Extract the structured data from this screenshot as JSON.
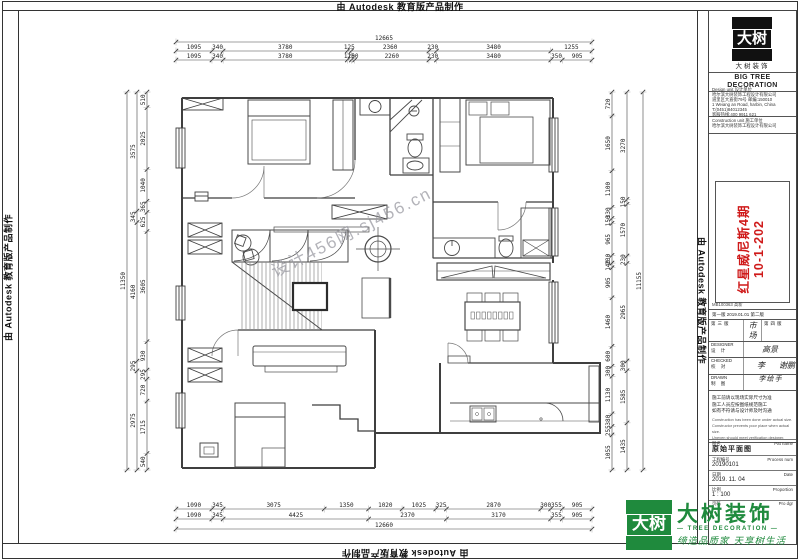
{
  "banner": {
    "text": "由 Autodesk 教育版产品制作"
  },
  "watermark": {
    "text": "设计456网.sj456.cn"
  },
  "dims": {
    "top": {
      "overall": "12665",
      "coarse": [
        "1095",
        "340",
        "3780",
        "125",
        "2360",
        "230",
        "3480",
        "1255"
      ],
      "fine": [
        "1095",
        "340",
        "3780",
        "125",
        "100",
        "2260",
        "230",
        "3480",
        "350",
        "905"
      ]
    },
    "bottom": {
      "overall": "12660",
      "fine": [
        "1090",
        "345",
        "3075",
        "1350",
        "1020",
        "1025",
        "325",
        "2870",
        "300",
        "355",
        "905"
      ],
      "coarse": [
        "1090",
        "345",
        "4425",
        "2370",
        "3170",
        "355",
        "905"
      ]
    },
    "left": {
      "overall": "11350",
      "fine": [
        "510",
        "2025",
        "1040",
        "365",
        "625",
        "3605",
        "930",
        "295",
        "720",
        "1715",
        "540"
      ],
      "coarse": [
        "3575",
        "345",
        "4160",
        "295",
        "2975"
      ]
    },
    "right": {
      "overall": "11155",
      "fine": [
        "720",
        "1650",
        "1100",
        "330",
        "150",
        "965",
        "230",
        "140",
        "905",
        "1460",
        "600",
        "300",
        "1130",
        "380",
        "255",
        "1055"
      ],
      "coarse": [
        "3270",
        "150",
        "1570",
        "230",
        "2965",
        "300",
        "1585",
        "1435"
      ]
    }
  },
  "titleblock": {
    "seal_text": "大树",
    "brand_cn": "大树装饰",
    "brand_en1": "BIG TREE",
    "brand_en2": "DECORATION",
    "design_label": "Design unit 设计单位",
    "design_company": "哈尔滨大树装饰工程设计有限公司",
    "design_addr1": "道里区大直街79号 邮编:150010",
    "design_addr2": "1 Weiang an Road, harbin, China",
    "design_phone": "T:(0451)84012345",
    "design_hotline": "客服热线:400 9911 621",
    "constr_label": "Construction unit 施工单位",
    "constr_company": "哈尔滨大树装饰工程设计有限公司",
    "project_name": "红星威尼斯4期",
    "project_no": "10-1-202",
    "code_row": "MB100363 高新",
    "rev_row": "第一版  2019.01.01        第二版",
    "row1_left": "第三版",
    "row1_val": "市场",
    "row1_right": "第四版",
    "designer_en": "DESIGNER",
    "designer_cn": "设 计",
    "designer_val": "高景",
    "checked_en": "CHECKED",
    "checked_cn": "校 对",
    "checked_val": "李",
    "checked_val2": "谢鹏",
    "drawn_en": "DRAWN",
    "drawn_cn": "制 图",
    "drawn_val": "手绘李",
    "note_cn_1": "施工前请以现场实际尺寸为准",
    "note_cn_2": "施工人员应按图纸规范施工",
    "note_cn_3": "如有不符请与设计师及时沟通",
    "note_en_1": "Construction has been done under actual size.",
    "note_en_2": "Constructor prevents poor place when actual size.",
    "note_en_3": "Uneven should meet verification designer.",
    "f_name_cn": "图名",
    "f_name_en": "Pat name",
    "f_name_val": "原始平面图",
    "f_no_cn": "工程编号",
    "f_no_en": "Process num",
    "f_no_val": "20190101",
    "f_date_cn": "日期",
    "f_date_en": "Date",
    "f_date_val": "2019. 11. 04",
    "f_scale_cn": "比例",
    "f_scale_en": "Proportion",
    "f_scale_val": "1 : 100",
    "f_page_cn": "页码",
    "f_page_en": "Pro dgr",
    "f_page_val": ""
  },
  "footer_logo": {
    "seal_text": "大树",
    "brand": "大树装饰",
    "sub": "— TREE DECORATION —",
    "slogan": "缔造品质家 天享树生活"
  },
  "colors": {
    "accent_red": "#cf1a1a",
    "accent_green": "#1f8a3d",
    "line": "#4a4a4a"
  }
}
